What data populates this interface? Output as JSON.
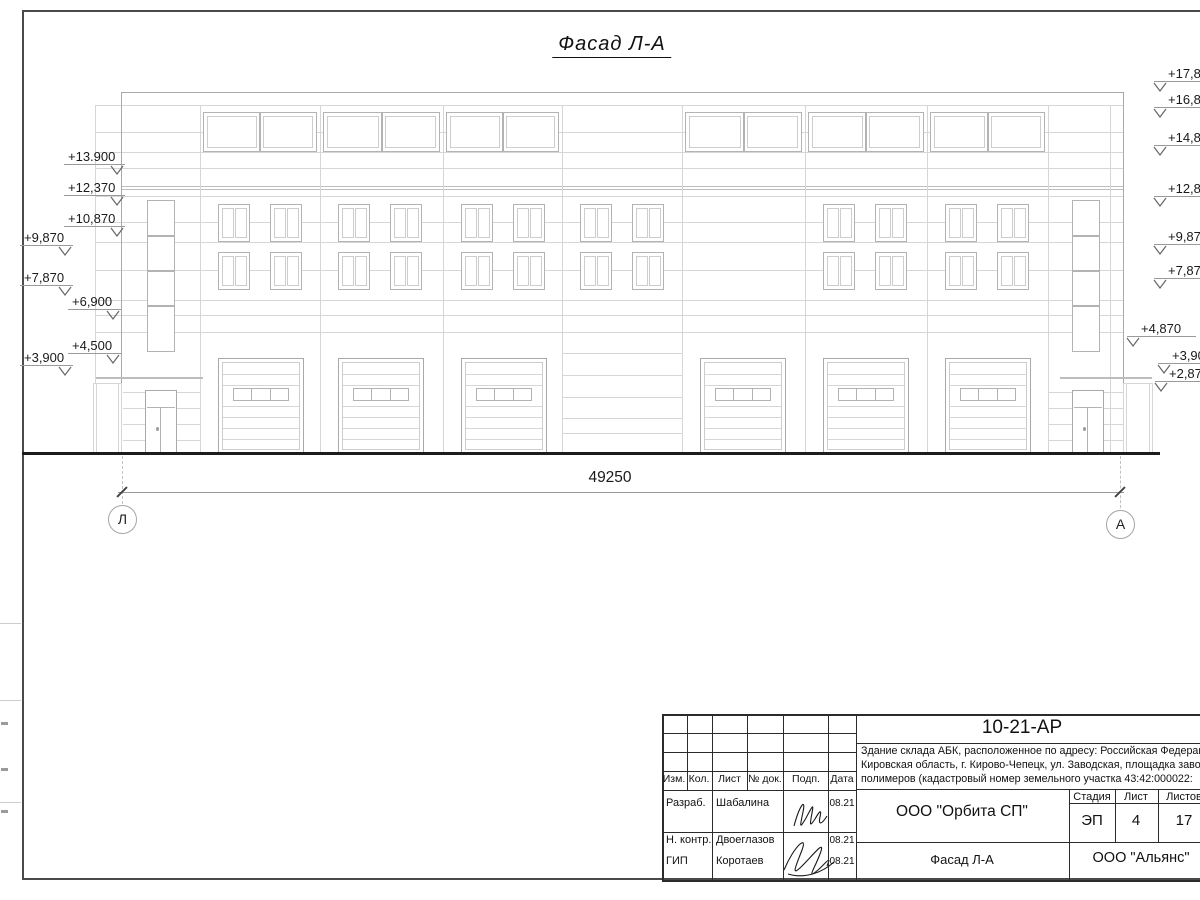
{
  "drawing": {
    "title": "Фасад Л-А",
    "dimension": "49250",
    "axis_left": "Л",
    "axis_right": "А",
    "elevations_left": [
      {
        "label": "+13.900",
        "x": 68,
        "y": 149
      },
      {
        "label": "+12,370",
        "x": 68,
        "y": 180
      },
      {
        "label": "+10,870",
        "x": 68,
        "y": 211
      },
      {
        "label": "+9,870",
        "x": 24,
        "y": 230
      },
      {
        "label": "+7,870",
        "x": 24,
        "y": 270
      },
      {
        "label": "+6,900",
        "x": 72,
        "y": 294
      },
      {
        "label": "+4,500",
        "x": 72,
        "y": 338
      },
      {
        "label": "+3,900",
        "x": 24,
        "y": 350
      }
    ],
    "elevations_right": [
      {
        "label": "+17,870",
        "x": 1168,
        "y": 66
      },
      {
        "label": "+16,870",
        "x": 1168,
        "y": 92
      },
      {
        "label": "+14,870",
        "x": 1168,
        "y": 130
      },
      {
        "label": "+12,870",
        "x": 1168,
        "y": 181
      },
      {
        "label": "+9,870",
        "x": 1168,
        "y": 229
      },
      {
        "label": "+7,870",
        "x": 1168,
        "y": 263
      },
      {
        "label": "+4,870",
        "x": 1141,
        "y": 321
      },
      {
        "label": "+3,900",
        "x": 1172,
        "y": 348
      },
      {
        "label": "+2,870",
        "x": 1169,
        "y": 366
      }
    ],
    "colors": {
      "line": "#d6d6d6",
      "mid": "#bdbdbd",
      "outline": "#a9a9a9",
      "frame": "#b3b3b3",
      "pane": "#cdcdcd",
      "ground": "#1c1c1c",
      "dim": "#9b9b9b",
      "dark": "#2b2b2b"
    },
    "facade": {
      "left": 121,
      "right": 1123,
      "top": 92,
      "ground": 452,
      "hlines": [
        105,
        132,
        152,
        168,
        196,
        222,
        242,
        270,
        300,
        315,
        332
      ],
      "strong_hlines": [
        186,
        189
      ],
      "bay_lines": [
        200,
        320,
        443,
        562,
        682,
        805,
        927,
        1048,
        1110
      ],
      "bays": [
        {
          "x0": 200,
          "x1": 320,
          "clerestory": true,
          "windows": true,
          "door": true
        },
        {
          "x0": 320,
          "x1": 443,
          "clerestory": true,
          "windows": true,
          "door": true
        },
        {
          "x0": 443,
          "x1": 562,
          "clerestory": true,
          "windows": true,
          "door": true
        },
        {
          "x0": 562,
          "x1": 682,
          "clerestory": false,
          "windows": true,
          "door": false
        },
        {
          "x0": 682,
          "x1": 805,
          "clerestory": true,
          "windows": false,
          "door": true
        },
        {
          "x0": 805,
          "x1": 927,
          "clerestory": true,
          "windows": true,
          "door": true
        },
        {
          "x0": 927,
          "x1": 1048,
          "clerestory": true,
          "windows": true,
          "door": true
        }
      ],
      "mid_blank_bay": {
        "x0": 562,
        "x1": 682,
        "lines": [
          353,
          375,
          397,
          418,
          433
        ]
      },
      "win_rows": [
        204,
        252
      ],
      "win_h": 38,
      "win_offsets": [
        18,
        70
      ],
      "win_w": 32,
      "cl_y": 112,
      "cl_h": 40,
      "door_y": 358,
      "door_h": 96,
      "door_off": 18,
      "door_w": 86,
      "towers": [
        {
          "x0": 123,
          "x1": 200,
          "win_x": 147,
          "door_x": 145,
          "porch": [
            93,
            121
          ],
          "canopy": [
            95,
            203
          ],
          "side_line": 95
        },
        {
          "x0": 1048,
          "x1": 1123,
          "win_x": 1072,
          "door_x": 1072,
          "porch": [
            1123,
            1152
          ],
          "canopy": [
            1060,
            1152
          ],
          "side_line": null
        }
      ]
    }
  },
  "title_block": {
    "doc_number": "10-21-АР",
    "description_lines": [
      "Здание склада АБК, расположенное по адресу: Российская Федерация,",
      "Кировская область, г. Кирово-Чепецк, ул. Заводская, площадка завода",
      "полимеров (кадастровый номер земельного участка 43:42:000022:"
    ],
    "header_cols": [
      "Изм.",
      "Кол.",
      "Лист",
      "№ док.",
      "Подп.",
      "Дата"
    ],
    "signature_rows": [
      {
        "role": "Разраб.",
        "name": "Шабалина",
        "date": "08.21"
      },
      {
        "role": "Н. контр.",
        "name": "Двоеглазов",
        "date": "08.21"
      },
      {
        "role": "ГИП",
        "name": "Коротаев",
        "date": "08.21"
      }
    ],
    "company": "ООО \"Орбита СП\"",
    "stage_label": "Стадия",
    "sheet_label": "Лист",
    "sheets_label": "Листов",
    "stage": "ЭП",
    "sheet_no": "4",
    "sheets_total": "17",
    "drawing_title": "Фасад Л-А",
    "contractor": "ООО \"Альянс\""
  }
}
